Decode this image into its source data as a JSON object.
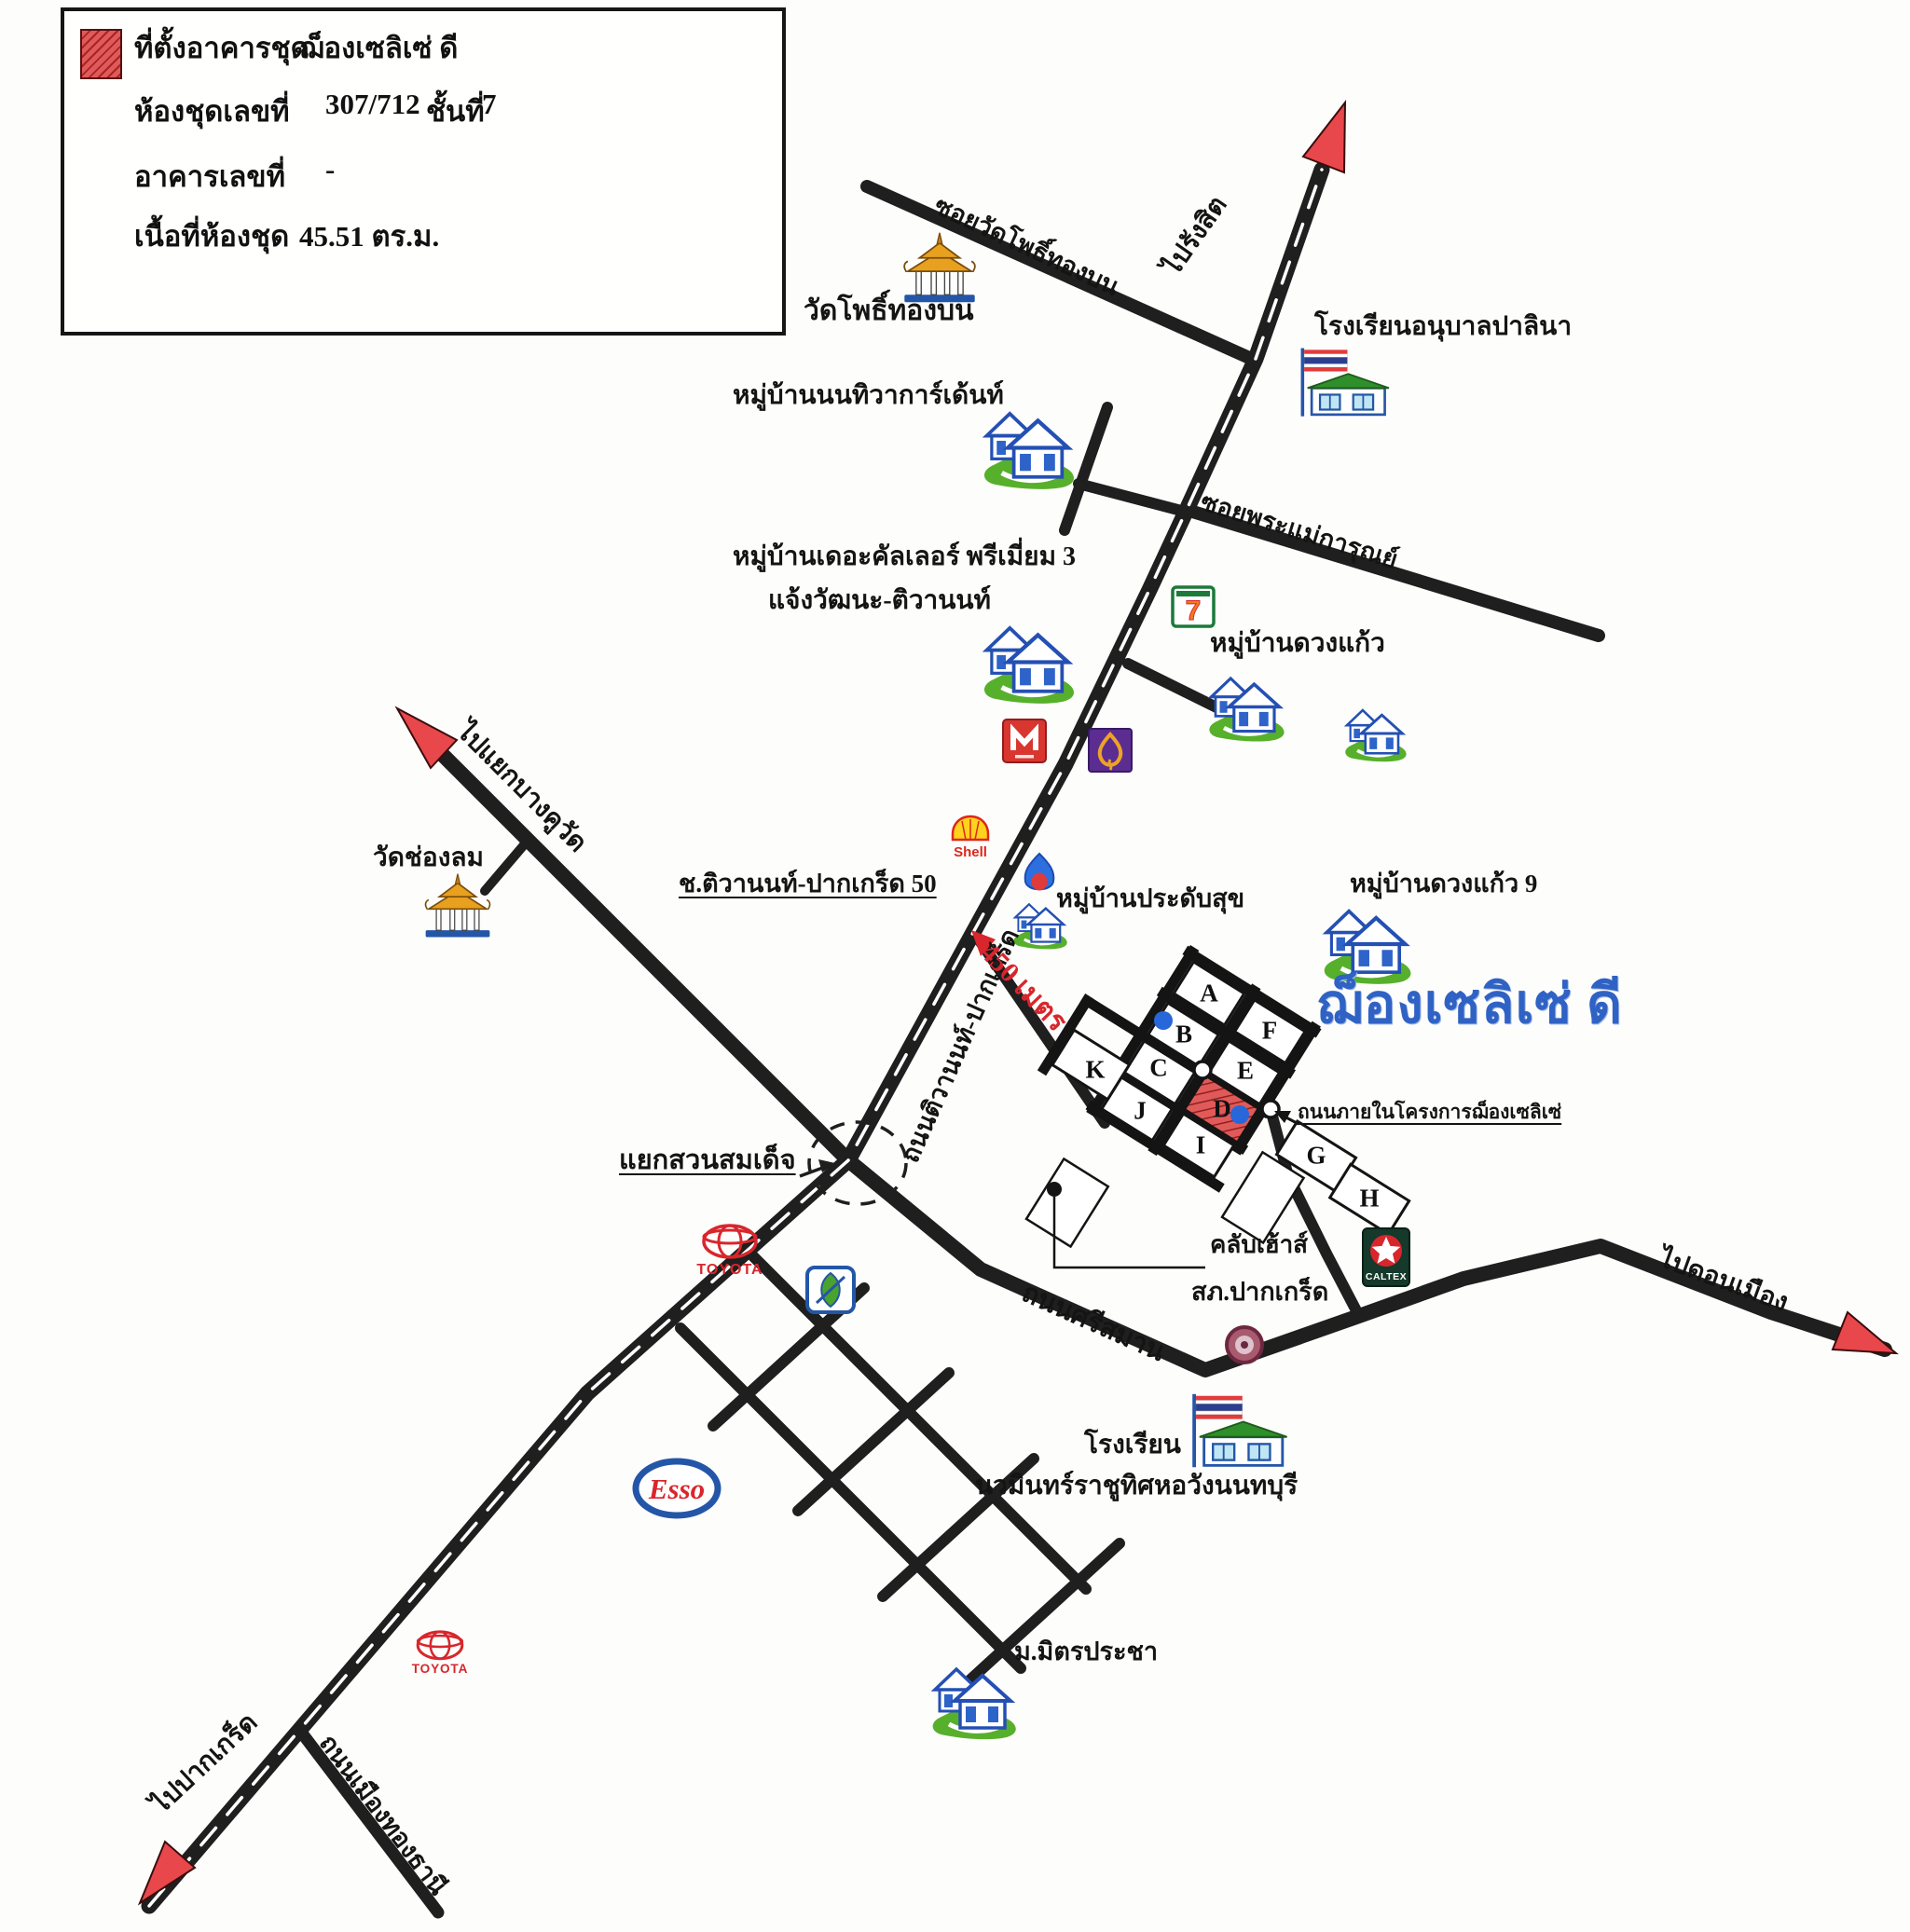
{
  "legend": {
    "swatch_icon": "red-hatched-square",
    "rows": [
      {
        "label": "ที่ตั้งอาคารชุด",
        "value": "ฌ็องเซลิเซ่ ดี"
      },
      {
        "label": "ห้องชุดเลขที่",
        "value": "307/712",
        "label2": "ชั้นที่",
        "value2": "7"
      },
      {
        "label": "อาคารเลขที่",
        "value": "-"
      },
      {
        "label": "เนื้อที่ห้องชุด",
        "value": "45.51 ตร.ม."
      }
    ]
  },
  "project": {
    "name": "ฌ็องเซลิเซ่ ดี",
    "distance": "450 เมตร",
    "internal_road": "ถนนภายในโครงการฌ็องเซลิเซ่",
    "clubhouse": "คลับเฮ้าส์",
    "blocks": [
      "A",
      "B",
      "C",
      "D",
      "E",
      "F",
      "G",
      "H",
      "I",
      "J",
      "K"
    ]
  },
  "roads": {
    "tiwanon_pakkret": "ถนนติวานนท์-ปากเกร็ด",
    "soi_wat_pho_thong": "ซอยวัดโพธิ์ทองบน",
    "soi_phra_mae_karun": "ซอยพระแม่การุณย์",
    "soi_tiwanon_50": "ช.ติวานนท์-ปากเกร็ด 50",
    "sri_saman": "ถนนศรีสมาน",
    "mueang_thong_thani": "ถนนเมืองทองธานี"
  },
  "directions": {
    "to_rangsit": "ไปรังสิต",
    "to_bang_khu_wat": "ไปแยกบางคูวัด",
    "to_don_mueang": "ไปดอนเมือง",
    "to_pakkret": "ไปปากเกร็ด"
  },
  "places": {
    "wat_pho_thong_bon": "วัดโพธิ์ทองบน",
    "anuban_palina": "โรงเรียนอนุบาลปาลินา",
    "nonthiwa_garden": "หมู่บ้านนนทิวาการ์เด้นท์",
    "colour_premium_1": "หมู่บ้านเดอะคัลเลอร์ พรีเมี่ยม 3",
    "colour_premium_2": "แจ้งวัฒนะ-ติวานนท์",
    "duang_kaew": "หมู่บ้านดวงแก้ว",
    "duang_kaew_9": "หมู่บ้านดวงแก้ว 9",
    "pradab_suk": "หมู่บ้านประดับสุข",
    "wat_chong_lom": "วัดช่องลม",
    "suan_somdet": "แยกสวนสมเด็จ",
    "police": "สภ.ปากเกร็ด",
    "school_1": "โรงเรียน",
    "school_2": "นวมินทร์ราชูทิศหอวังนนทบุรี",
    "mit_pracha": "ม.มิตรประชา"
  },
  "brands": {
    "shell": "Shell",
    "esso": "Esso",
    "toyota": "TOYOTA",
    "caltex": "CALTEX",
    "seven_eleven": "7"
  },
  "icons": [
    "house-icon",
    "temple-icon",
    "school-flag-icon",
    "shell-gas-icon",
    "ptt-gas-icon",
    "seven-eleven-icon",
    "cinema-m-icon",
    "lotus-leaf-icon",
    "toyota-icon",
    "bangchak-icon",
    "esso-icon",
    "caltex-icon",
    "police-badge-icon",
    "red-arrow-icon"
  ],
  "colors": {
    "road": "#1f1f1f",
    "arrow_red": "#e8474b",
    "project_blue": "#2f62c4",
    "hatch_red": "#e05a5a",
    "house_blue": "#2450b4",
    "grass_green": "#57b02c"
  }
}
